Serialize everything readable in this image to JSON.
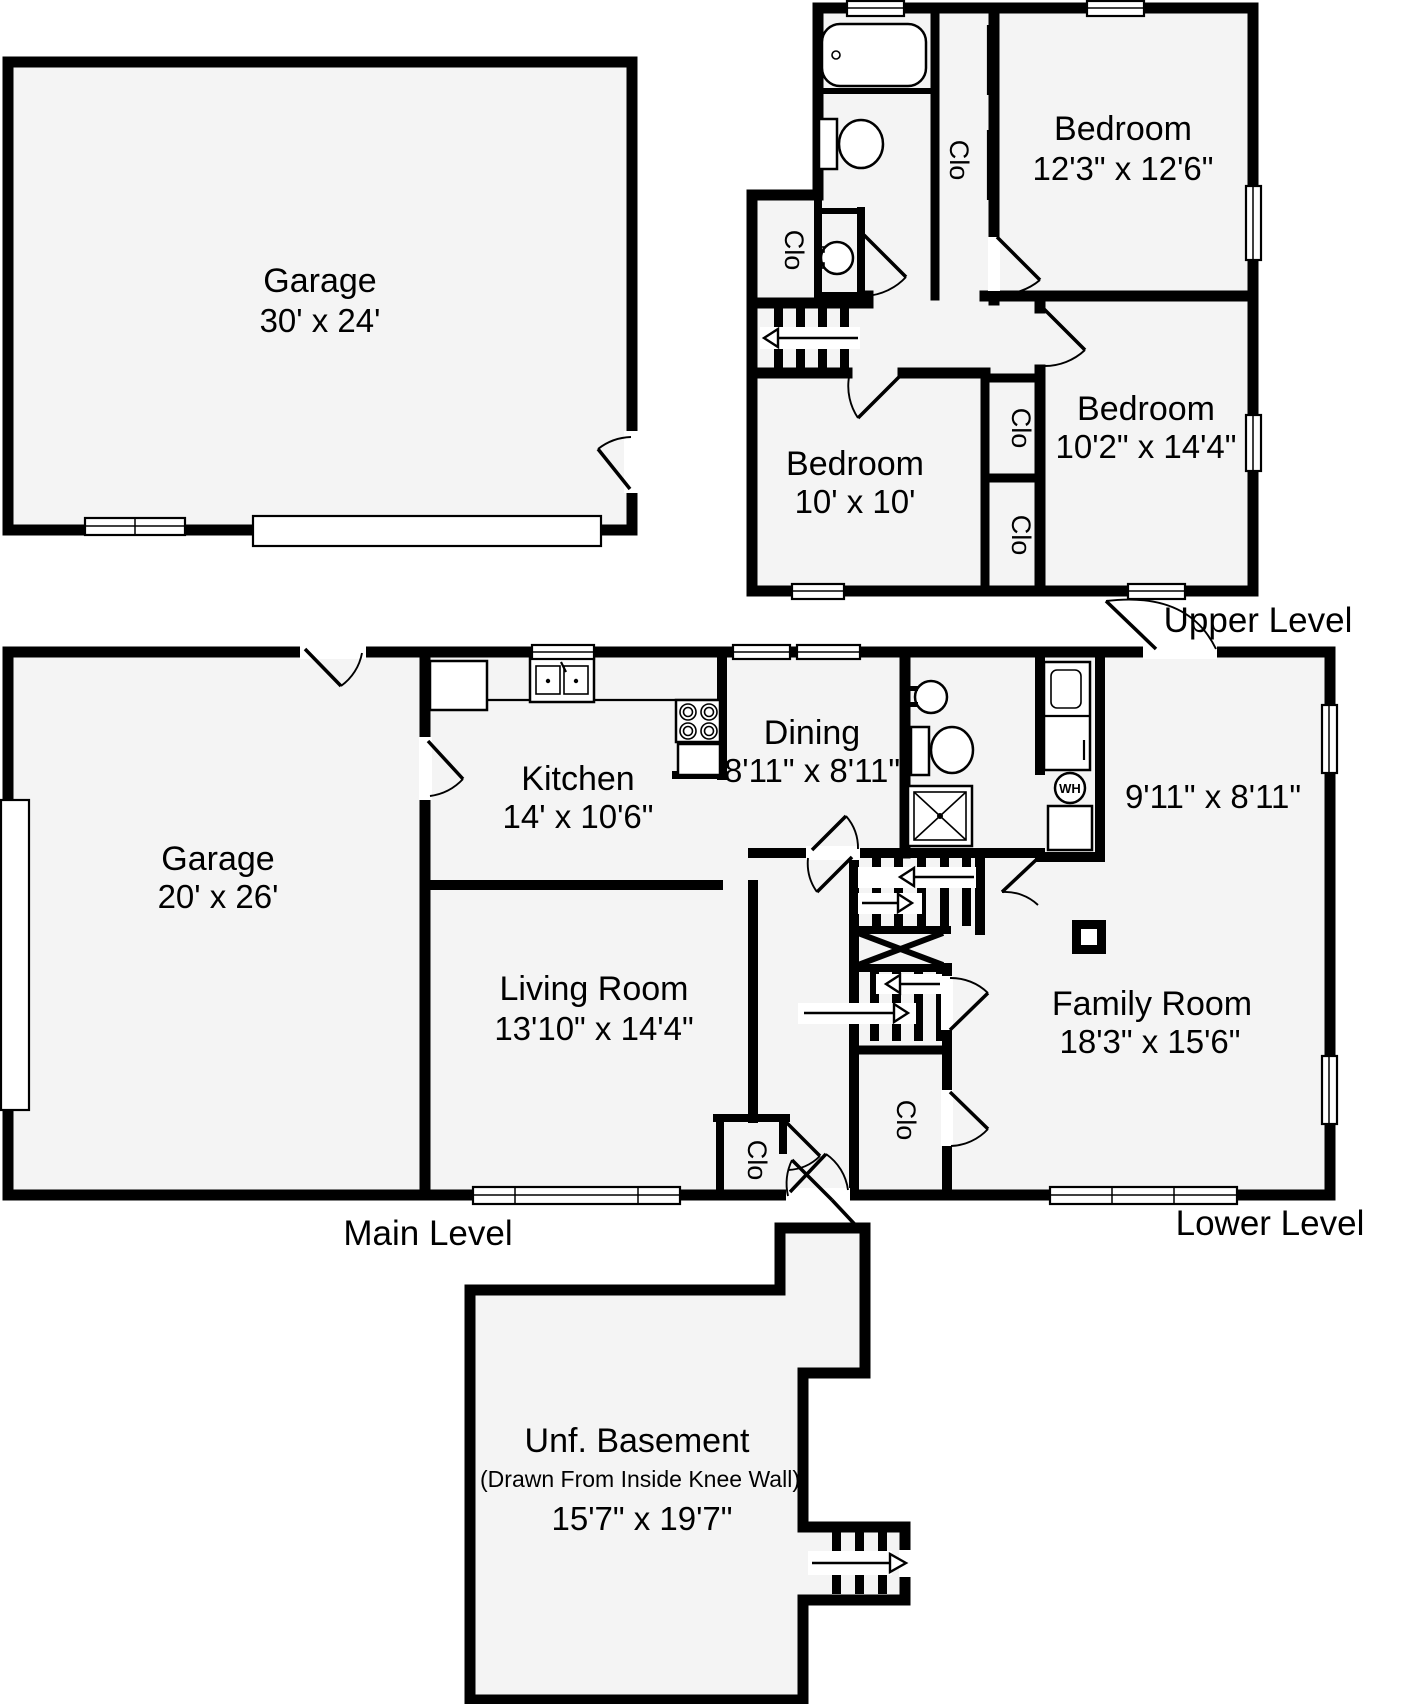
{
  "floorplan": {
    "levels": {
      "upper": {
        "label": "Upper Level"
      },
      "main": {
        "label": "Main Level"
      },
      "lower": {
        "label": "Lower Level"
      }
    },
    "rooms": {
      "garage_upper": {
        "name": "Garage",
        "dims": "30' x 24'"
      },
      "bedroom_master": {
        "name": "Bedroom",
        "dims": "12'3\" x 12'6\""
      },
      "bedroom_mid": {
        "name": "Bedroom",
        "dims": "10'2\" x 14'4\""
      },
      "bedroom_small": {
        "name": "Bedroom",
        "dims": "10' x 10'"
      },
      "garage_main": {
        "name": "Garage",
        "dims": "20' x 26'"
      },
      "kitchen": {
        "name": "Kitchen",
        "dims": "14' x 10'6\""
      },
      "dining": {
        "name": "Dining",
        "dims": "8'11\" x 8'11\""
      },
      "living_room": {
        "name": "Living Room",
        "dims": "13'10\" x 14'4\""
      },
      "family_room": {
        "name": "Family Room",
        "dims": "18'3\" x 15'6\""
      },
      "utility_room": {
        "dims": "9'11\" x 8'11\""
      },
      "basement": {
        "name": "Unf. Basement",
        "note": "(Drawn From Inside Knee Wall)",
        "dims": "15'7\" x 19'7\""
      }
    },
    "labels": {
      "closet": "Clo",
      "water_heater": "WH"
    }
  }
}
